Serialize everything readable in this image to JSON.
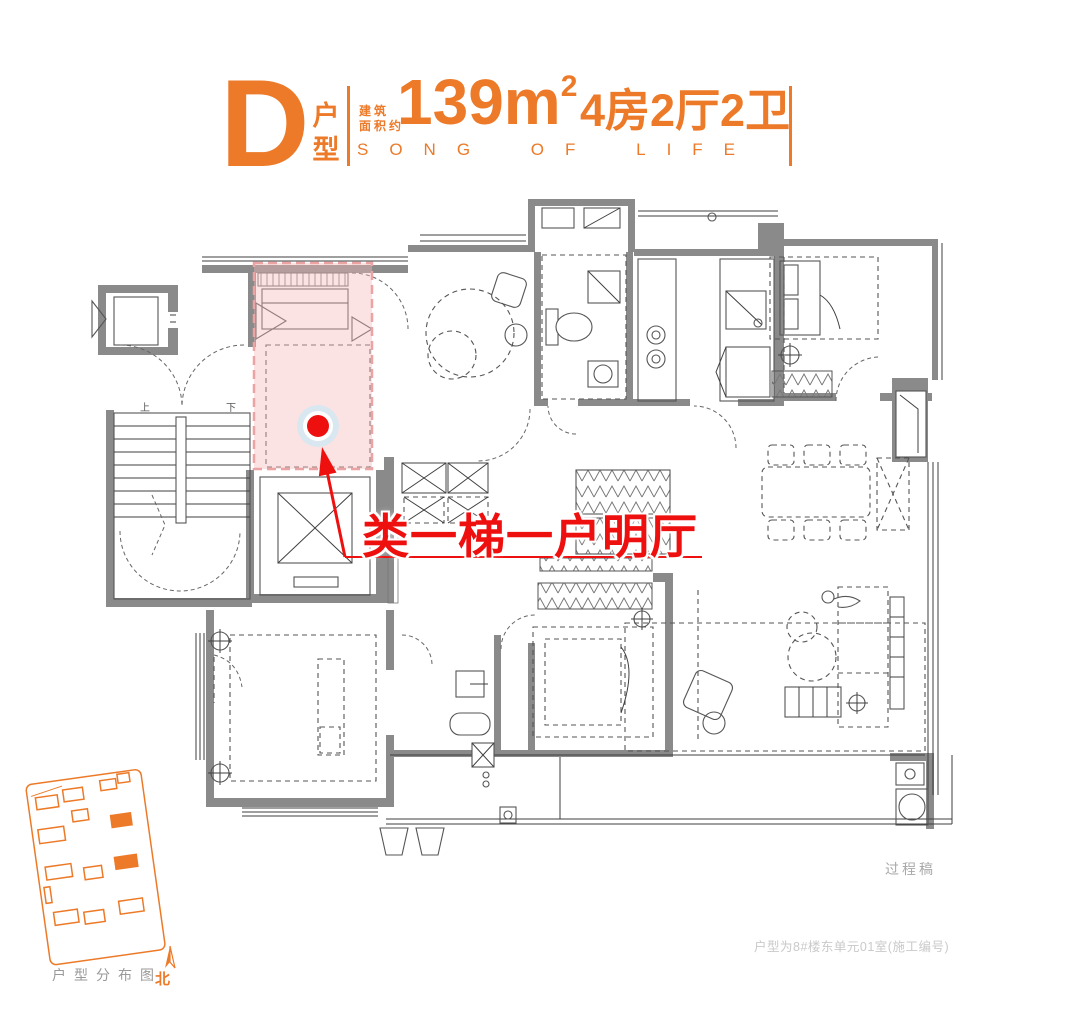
{
  "header": {
    "type_letter": "D",
    "type_suffix_line1": "户",
    "type_suffix_line2": "型",
    "area_prefix_line1": "建筑",
    "area_prefix_line2": "面积约",
    "area_value": "139m",
    "area_sup": "2",
    "layout": "4房2厅2卫",
    "slogan": "SONG OF LIFE"
  },
  "plan": {
    "annotation_text": "类一梯一户明厅",
    "stair_up_label": "上",
    "stair_down_label": "下"
  },
  "footer": {
    "site_map_caption": "户型分布图",
    "north_label": "北",
    "draft_label": "过程稿",
    "unit_note": "户型为8#楼东单元01室(施工编号)"
  },
  "colors": {
    "accent_orange": "#EC7A28",
    "annotation_red": "#EE0F0F",
    "wall_gray": "#8A8A8A",
    "highlight_pink": "#F6B9B9",
    "dot_halo_blue": "#D9E7F0"
  }
}
